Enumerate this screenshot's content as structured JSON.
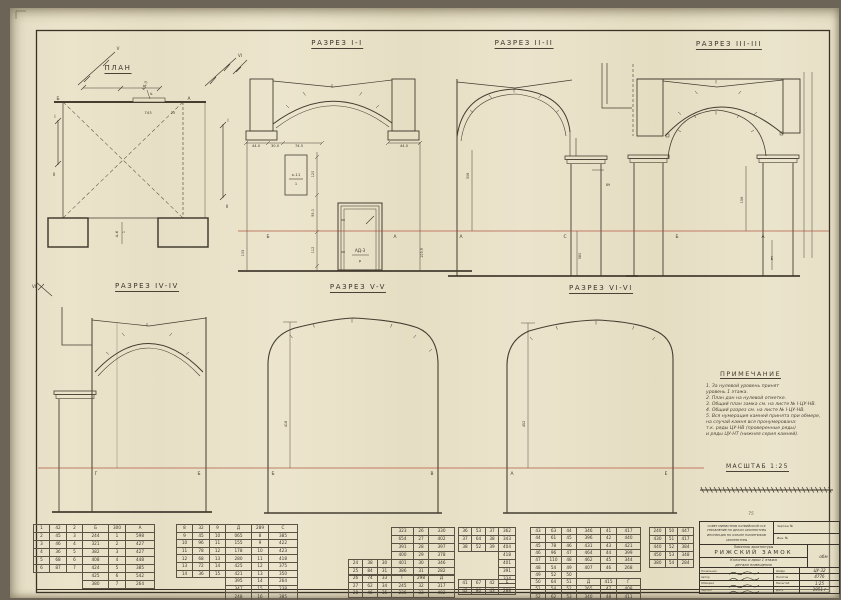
{
  "titles": {
    "plan": "ПЛАН",
    "s1": "РАЗРЕЗ I-I",
    "s2": "РАЗРЕЗ II-II",
    "s3": "РАЗРЕЗ III-III",
    "s4": "РАЗРЕЗ IV-IV",
    "s5": "РАЗРЕЗ V-V",
    "s6": "РАЗРЕЗ VI-VI"
  },
  "notes": {
    "title": "ПРИМЕЧАНИЕ",
    "lines": [
      "1. За нулевой уровень принят",
      "    уровень 1 этажа.",
      "2. План дан на нулевой отметке.",
      "3. Общий план замка см. на листе № I-ЦУ-НВ.",
      "4. Общий разрез см. на листе № I-ЦУ-НВ.",
      "5. Вся нумерация камней принята при обмере,",
      "    на случай камня вся пронумерована:",
      "    т.к. ряды ЦУ-НВ (проверенные ряды)",
      "    и ряды ЦУ-НТ (нижняя серия камней)."
    ]
  },
  "scale": {
    "label": "МАСШТАБ 1:25"
  },
  "colors": {
    "paper": "#e9e1c6",
    "ink": "#3a332b",
    "datum_red": "#a8452f"
  },
  "labels": [
    {
      "n": "plan-corner-b",
      "t": "Б",
      "x": 58,
      "y": 100,
      "s": 4.4
    },
    {
      "n": "plan-corner-a",
      "t": "А",
      "x": 189,
      "y": 100,
      "s": 4.4
    },
    {
      "n": "plan-dim-743",
      "t": "743",
      "x": 148,
      "y": 114,
      "s": 3.8
    },
    {
      "n": "plan-dim-25",
      "t": "25",
      "x": 173,
      "y": 114,
      "s": 3.4
    },
    {
      "n": "plan-door-mark",
      "t": "АД-3",
      "x": 146,
      "y": 86,
      "r": -70,
      "s": 3.8
    },
    {
      "n": "plan-door-mark-den",
      "t": "р",
      "x": 152,
      "y": 94,
      "r": -70,
      "s": 3.4
    },
    {
      "n": "plan-opening-mark",
      "t": "А-6",
      "x": 118,
      "y": 234,
      "r": -90,
      "s": 3.8
    },
    {
      "n": "plan-opening-mark-den",
      "t": "1",
      "x": 125,
      "y": 232,
      "r": -90,
      "s": 3.4
    },
    {
      "n": "cut-marker-v",
      "t": "V",
      "x": 118,
      "y": 50,
      "s": 4
    },
    {
      "n": "cut-marker-vi-top",
      "t": "VI",
      "x": 240,
      "y": 57,
      "s": 4
    },
    {
      "n": "cut-marker-i-left",
      "t": "I",
      "x": 55,
      "y": 118,
      "s": 4
    },
    {
      "n": "cut-marker-ii-left",
      "t": "II",
      "x": 54,
      "y": 176,
      "s": 4
    },
    {
      "n": "cut-marker-i-right",
      "t": "I",
      "x": 228,
      "y": 122,
      "s": 4
    },
    {
      "n": "cut-marker-ii-right",
      "t": "II",
      "x": 227,
      "y": 208,
      "s": 4
    },
    {
      "n": "cut-marker-vi-bottom",
      "t": "VI",
      "x": 34,
      "y": 288,
      "s": 4
    },
    {
      "n": "s1-dim-44-left",
      "t": "44.0",
      "x": 256,
      "y": 147,
      "s": 3.6
    },
    {
      "n": "s1-dim-30",
      "t": "30.0",
      "x": 275,
      "y": 147,
      "s": 3.6
    },
    {
      "n": "s1-dim-745",
      "t": "74.5",
      "x": 299,
      "y": 147,
      "s": 3.6
    },
    {
      "n": "s1-dim-44-right",
      "t": "44.0",
      "x": 404,
      "y": 147,
      "s": 3.6
    },
    {
      "n": "s1-detail-k11",
      "t": "к-11",
      "x": 296,
      "y": 176,
      "s": 3.9
    },
    {
      "n": "s1-detail-k11-den",
      "t": "1",
      "x": 296,
      "y": 185,
      "s": 3.6
    },
    {
      "n": "s1-door-mark",
      "t": "АД-3",
      "x": 360,
      "y": 252,
      "s": 4.2
    },
    {
      "n": "s1-door-mark-den",
      "t": "р",
      "x": 360,
      "y": 262,
      "s": 3.8
    },
    {
      "n": "s1-dim-120",
      "t": "120",
      "x": 314,
      "y": 174,
      "r": -90,
      "s": 3.4
    },
    {
      "n": "s1-dim-95",
      "t": "95.0",
      "x": 314,
      "y": 213,
      "r": -90,
      "s": 3.4
    },
    {
      "n": "s1-dim-112",
      "t": "112",
      "x": 314,
      "y": 250,
      "r": -90,
      "s": 3.4
    },
    {
      "n": "s1-dim-105",
      "t": "105",
      "x": 244,
      "y": 253,
      "r": -90,
      "s": 3.4
    },
    {
      "n": "s1-dim-1039",
      "t": "103.9",
      "x": 423,
      "y": 253,
      "r": -90,
      "s": 3.4
    },
    {
      "n": "s1-axis-b",
      "t": "Б",
      "x": 268,
      "y": 238,
      "s": 4.4
    },
    {
      "n": "s1-axis-a",
      "t": "А",
      "x": 395,
      "y": 238,
      "s": 4.4
    },
    {
      "n": "s2-dim-306",
      "t": "306",
      "x": 469,
      "y": 176,
      "r": -90,
      "s": 3.4
    },
    {
      "n": "s2-dim-89",
      "t": "89",
      "x": 608,
      "y": 186,
      "s": 3.4
    },
    {
      "n": "s2-dim-580",
      "t": "580",
      "x": 581,
      "y": 256,
      "r": -90,
      "s": 3.4
    },
    {
      "n": "s2-axis-a",
      "t": "А",
      "x": 461,
      "y": 238,
      "s": 4.4
    },
    {
      "n": "s2-axis-c",
      "t": "С",
      "x": 565,
      "y": 238,
      "s": 4.4
    },
    {
      "n": "s3-dim-156",
      "t": "156",
      "x": 743,
      "y": 200,
      "r": -90,
      "s": 3.4
    },
    {
      "n": "s3-axis-b",
      "t": "Б",
      "x": 677,
      "y": 238,
      "s": 4.4
    },
    {
      "n": "s3-axis-a",
      "t": "А",
      "x": 763,
      "y": 238,
      "s": 4.4
    },
    {
      "n": "s3-mark-e",
      "t": "Е",
      "x": 772,
      "y": 260,
      "s": 4
    },
    {
      "n": "s4-axis-g",
      "t": "Г",
      "x": 96,
      "y": 475,
      "s": 4.4
    },
    {
      "n": "s4-axis-b",
      "t": "Б",
      "x": 199,
      "y": 475,
      "s": 4.4
    },
    {
      "n": "s5-dim-418",
      "t": "418",
      "x": 287,
      "y": 424,
      "r": -90,
      "s": 3.4
    },
    {
      "n": "s5-axis-b",
      "t": "Б",
      "x": 273,
      "y": 475,
      "s": 4.4
    },
    {
      "n": "s5-axis-v",
      "t": "В",
      "x": 432,
      "y": 475,
      "s": 4.4
    },
    {
      "n": "s6-dim-452",
      "t": "452",
      "x": 525,
      "y": 424,
      "r": -90,
      "s": 3.4
    },
    {
      "n": "s6-axis-a",
      "t": "А",
      "x": 512,
      "y": 475,
      "s": 4.4
    },
    {
      "n": "s6-axis-e",
      "t": "Е",
      "x": 666,
      "y": 475,
      "s": 4.4
    },
    {
      "n": "pencil-note",
      "t": "75",
      "x": 751,
      "y": 515,
      "s": 4.4,
      "c": "pencil"
    }
  ],
  "tables": {
    "t1": {
      "widths": [
        15,
        16,
        15,
        25,
        16,
        28
      ],
      "rh": 7,
      "rows": [
        [
          "1",
          "42",
          "2",
          "Б",
          "300",
          "А"
        ],
        [
          "2",
          "45",
          "3",
          "244",
          "1",
          "598"
        ],
        [
          "3",
          "46",
          "4",
          "321",
          "2",
          "427"
        ],
        [
          "4",
          "36",
          "5",
          "382",
          "3",
          "427"
        ],
        [
          "5",
          "68",
          "6",
          "408",
          "4",
          "448"
        ],
        [
          "6",
          "87",
          "7",
          "424",
          "5",
          "385"
        ],
        [
          "",
          "",
          "",
          "425",
          "6",
          "542"
        ],
        [
          "",
          "",
          "",
          "380",
          "7",
          "264"
        ]
      ]
    },
    "t2": {
      "widths": [
        15,
        16,
        15,
        25,
        16,
        28
      ],
      "rh": 6.6,
      "rows": [
        [
          "8",
          "32",
          "9",
          "Д",
          "289",
          "С"
        ],
        [
          "9",
          "45",
          "10",
          "065",
          "8",
          "385"
        ],
        [
          "10",
          "96",
          "11",
          "155",
          "9",
          "422"
        ],
        [
          "11",
          "78",
          "12",
          "178",
          "10",
          "423"
        ],
        [
          "12",
          "68",
          "13",
          "280",
          "11",
          "418"
        ],
        [
          "13",
          "72",
          "14",
          "425",
          "12",
          "375"
        ],
        [
          "14",
          "36",
          "15",
          "421",
          "13",
          "350"
        ],
        [
          "",
          "",
          "",
          "395",
          "14",
          "264"
        ],
        [
          "",
          "",
          "",
          "347",
          "15",
          "238"
        ],
        [
          "",
          "",
          "",
          "248",
          "16",
          "385"
        ]
      ]
    },
    "t3": {
      "widths": [
        13,
        14,
        13,
        21,
        14,
        25
      ],
      "rh": 7,
      "rows": [
        [
          "",
          "",
          "",
          "323",
          "26",
          "330"
        ],
        [
          "",
          "",
          "",
          "654",
          "27",
          "402"
        ],
        [
          "",
          "",
          "",
          "391",
          "28",
          "397"
        ],
        [
          "",
          "",
          "",
          "400",
          "29",
          "378"
        ],
        [
          "24",
          "38",
          "30",
          "401",
          "30",
          "346"
        ],
        [
          "25",
          "84",
          "31",
          "386",
          "31",
          "282"
        ]
      ]
    },
    "t4": {
      "widths": [
        13,
        14,
        13,
        21,
        14,
        25
      ],
      "rh": 6.6,
      "rows": [
        [
          "26",
          "74",
          "33",
          "Г",
          "298",
          "Д"
        ],
        [
          "27",
          "62",
          "34",
          "245",
          "32",
          "317"
        ],
        [
          "28",
          "46",
          "35",
          "236",
          "33",
          "402"
        ]
      ]
    },
    "t5": {
      "widths": [
        12,
        13,
        12,
        16
      ],
      "rh": 7,
      "rows": [
        [
          "36",
          "53",
          "37",
          "362"
        ],
        [
          "37",
          "64",
          "38",
          "343"
        ],
        [
          "38",
          "52",
          "39",
          "404"
        ],
        [
          "",
          "",
          "",
          "418"
        ],
        [
          "",
          "",
          "",
          "401"
        ],
        [
          "",
          "",
          "",
          "391"
        ],
        [
          "",
          "",
          "",
          "334"
        ]
      ]
    },
    "t6": {
      "widths": [
        12,
        13,
        12,
        16
      ],
      "rh": 6.6,
      "rows": [
        [
          "41",
          "67",
          "42",
          "Б"
        ],
        [
          "42",
          "80",
          "43",
          "288"
        ]
      ]
    },
    "t7": {
      "widths": [
        14,
        15,
        14,
        23,
        15,
        23
      ],
      "rh": 6.3,
      "rows": [
        [
          "43",
          "63",
          "44",
          "346",
          "41",
          "417"
        ],
        [
          "44",
          "61",
          "45",
          "396",
          "42",
          "440"
        ],
        [
          "45",
          "78",
          "46",
          "431",
          "43",
          "421"
        ],
        [
          "46",
          "96",
          "47",
          "464",
          "44",
          "399"
        ],
        [
          "47",
          "110",
          "48",
          "462",
          "45",
          "344"
        ],
        [
          "48",
          "54",
          "49",
          "407",
          "46",
          "268"
        ],
        [
          "49",
          "52",
          "50",
          "",
          "",
          ""
        ],
        [
          "50",
          "64",
          "51",
          "Д",
          "415",
          "Г"
        ],
        [
          "51",
          "54",
          "52",
          "265",
          "47",
          "408"
        ],
        [
          "52",
          "62",
          "53",
          "340",
          "48",
          "411"
        ]
      ]
    },
    "t8": {
      "widths": [
        15,
        11,
        15
      ],
      "rh": 7,
      "rows": [
        [
          "240",
          "50",
          "447"
        ],
        [
          "430",
          "51",
          "417"
        ],
        [
          "440",
          "52",
          "384"
        ],
        [
          "450",
          "53",
          "348"
        ],
        [
          "380",
          "54",
          "284"
        ]
      ]
    }
  },
  "titleblock": {
    "org_lines": [
      "СОВЕТ МИНИСТРОВ ЛАТВИЙСКОЙ ССР",
      "УПРАВЛЕНИЕ ПО ДЕЛАМ АРХИТЕКТУРЫ",
      "ИНСПЕКЦИЯ ПО ОХРАНЕ ПАМЯТНИКОВ",
      "АРХИТЕКТУРЫ"
    ],
    "reg_rows": [
      "Чертеж №",
      "Инв. №"
    ],
    "monument_label": "Памятник архитектуры",
    "object_name": "РИЖСКИЙ ЗАМОК",
    "subject_lines": [
      "Колонны и арки 1 этажа",
      "детали помещения"
    ],
    "stamp": "обм",
    "sig_rows": [
      "Начальник",
      "Автор",
      "Обмерил",
      "Чертил"
    ],
    "info_rows": [
      {
        "label": "Шифр",
        "value": "ЦУ-32"
      },
      {
        "label": "Негатив",
        "value": "4776"
      },
      {
        "label": "Масштаб",
        "value": "1:25"
      },
      {
        "label": "Дата",
        "value": "1951 г"
      }
    ]
  }
}
